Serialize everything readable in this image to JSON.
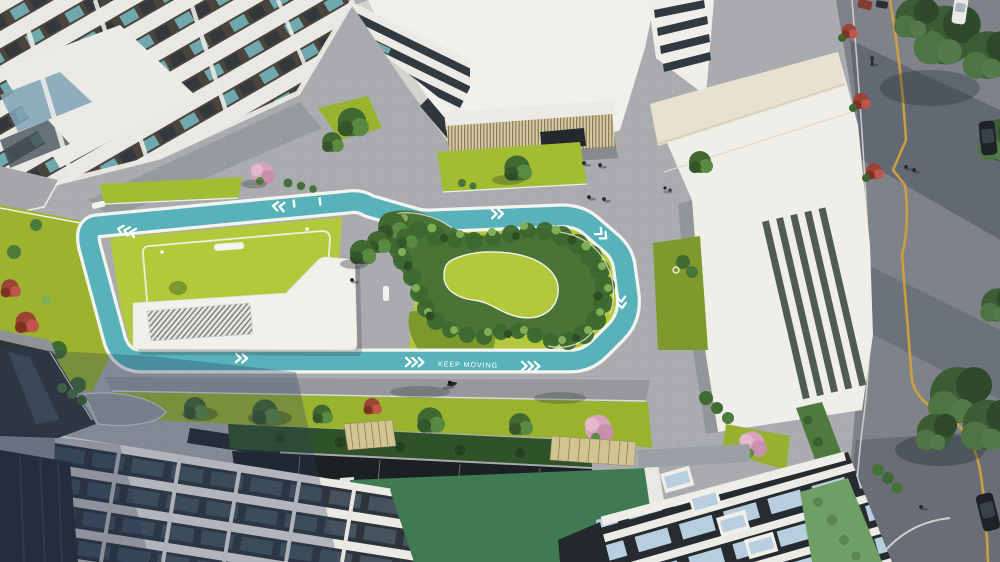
{
  "scene": {
    "type": "aerial architectural 3D rendering",
    "description": "Top-down aerial render of a residential complex courtyard: a teal jogging loop labelled KEEP MOVING encircles lawns, an organic shrub garden and a white pavilion; white towers frame the top and bottom, a louvered white building and a tree-lined street with a yellow line run along the right side, green roofs and pergolas along the bottom."
  },
  "track": {
    "label": "KEEP MOVING",
    "color": "#57b2ba",
    "edge_color": "#f3f4f0",
    "marking_color": "#ffffff"
  },
  "palette": {
    "lawn_bright": "#b3c93b",
    "lawn_mid": "#9ab32f",
    "lawn_shadow": "#76922a",
    "plaza_gray": "#a9abae",
    "road_gray": "#7e838a",
    "road_line_yellow": "#d2a23c",
    "building_white": "#efeee8",
    "building_cream": "#e8e1cf",
    "glass_dark": "#2c3238",
    "glass_blue": "#b7cede",
    "shrub_dark": "#3f6b31",
    "shrub_light": "#7fae55",
    "blossom_pink": "#d8a3bd",
    "maple_red": "#a8472f",
    "green_roof": "#3f7a52",
    "louver_beige": "#d6cba3",
    "hedge_dark": "#2f5229"
  }
}
